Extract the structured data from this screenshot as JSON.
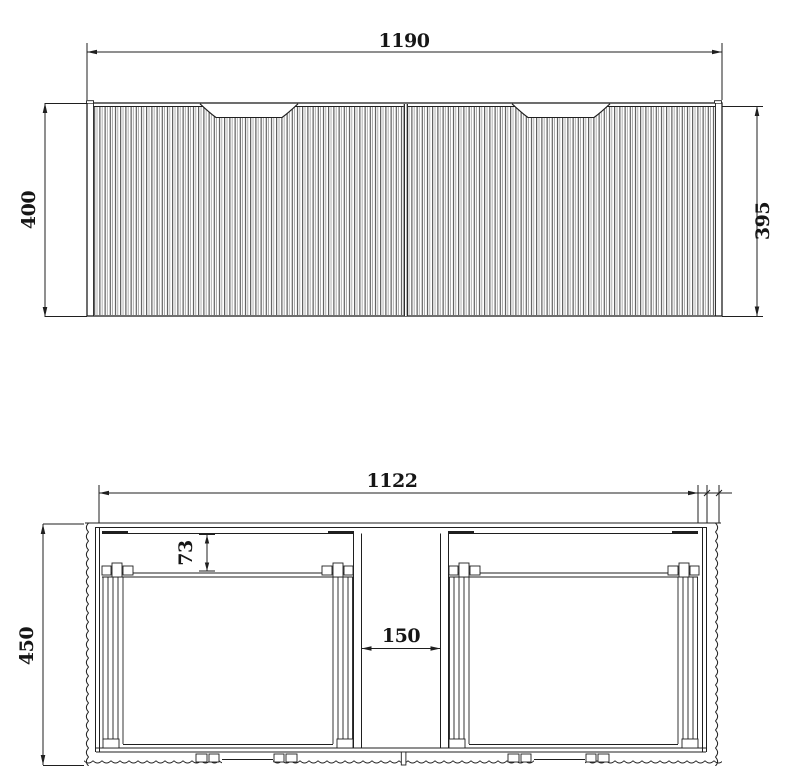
{
  "meta": {
    "description": "Technical dimension drawing of a wall-hung fluted double-drawer vanity cabinet: front elevation (top) and horizontal plan section (bottom)",
    "line_color": "#1f1f1f"
  },
  "front_view": {
    "label": "front-elevation",
    "width": "1190",
    "height_left": "400",
    "height_right": "395"
  },
  "plan_view": {
    "label": "plan-section",
    "inner_width": "1122",
    "depth": "450",
    "back_offset": "73",
    "center_gap": "150"
  }
}
